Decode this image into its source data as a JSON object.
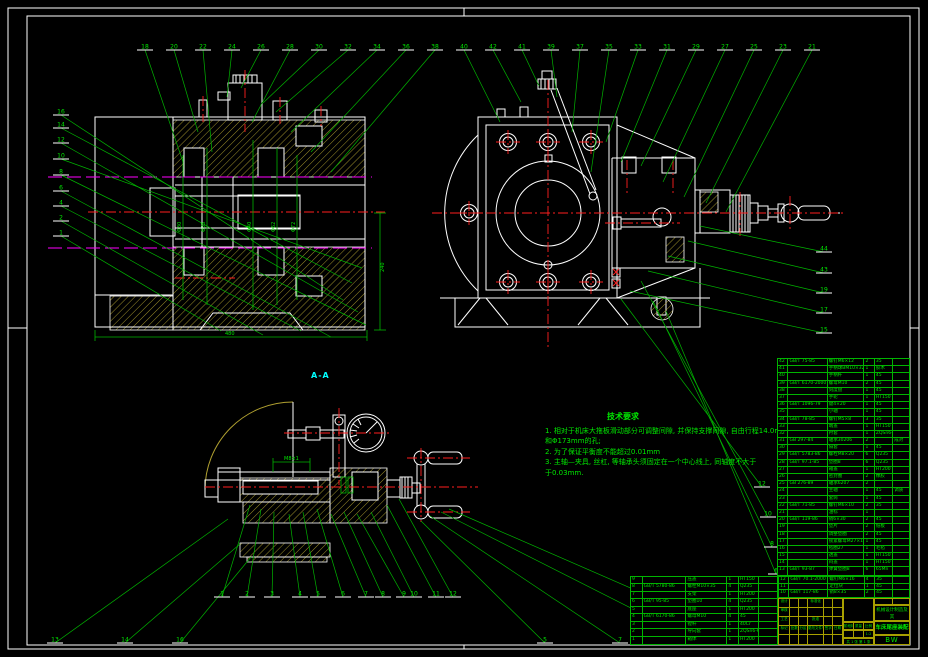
{
  "labels": {
    "section": "A-A"
  },
  "notes": {
    "title": "技术要求",
    "lines": [
      "1. 相对于机床大拖板滑动部分可调整间隙, 并保持支撑间隙, 自由行程14.0mm",
      "和Φ173mm的孔;",
      "2. 为了保证平衡度不能超过0.01mm",
      "3. 主轴—夹具, 丝杠, 等轴承头须固定在一个中心线上,  同轴度不大于",
      "于0.03mm."
    ]
  },
  "dims": {
    "texts": [
      {
        "x": 225,
        "y": 335,
        "s": "480"
      },
      {
        "x": 384,
        "y": 272,
        "rot": -90,
        "s": "240"
      },
      {
        "x": 181,
        "y": 232,
        "rot": -90,
        "s": "Φ30"
      },
      {
        "x": 205,
        "y": 232,
        "rot": -90,
        "s": "Φ35"
      },
      {
        "x": 251,
        "y": 232,
        "rot": -90,
        "s": "Φ40"
      },
      {
        "x": 275,
        "y": 232,
        "rot": -90,
        "s": "Φ62"
      },
      {
        "x": 295,
        "y": 232,
        "rot": -90,
        "s": "Φ72"
      },
      {
        "x": 284,
        "y": 460,
        "s": "M8×1"
      }
    ]
  },
  "callouts": {
    "groups": [
      {
        "name": "top",
        "items": [
          {
            "x": 145,
            "y": 50,
            "tx": 183,
            "ty": 162,
            "n": "18"
          },
          {
            "x": 174,
            "y": 50,
            "tx": 198,
            "ty": 132,
            "n": "20"
          },
          {
            "x": 203,
            "y": 50,
            "tx": 212,
            "ty": 152,
            "n": "22"
          },
          {
            "x": 232,
            "y": 50,
            "tx": 227,
            "ty": 97,
            "n": "24"
          },
          {
            "x": 261,
            "y": 50,
            "tx": 241,
            "ty": 88,
            "n": "26"
          },
          {
            "x": 290,
            "y": 50,
            "tx": 252,
            "ty": 122,
            "n": "28"
          },
          {
            "x": 319,
            "y": 50,
            "tx": 263,
            "ty": 103,
            "n": "30"
          },
          {
            "x": 348,
            "y": 50,
            "tx": 276,
            "ty": 112,
            "n": "32"
          },
          {
            "x": 377,
            "y": 50,
            "tx": 291,
            "ty": 132,
            "n": "34"
          },
          {
            "x": 406,
            "y": 50,
            "tx": 311,
            "ty": 152,
            "n": "36"
          },
          {
            "x": 435,
            "y": 50,
            "tx": 331,
            "ty": 172,
            "n": "38"
          },
          {
            "x": 464,
            "y": 50,
            "tx": 500,
            "ty": 122,
            "n": "40"
          },
          {
            "x": 493,
            "y": 50,
            "tx": 521,
            "ty": 102,
            "n": "42"
          },
          {
            "x": 522,
            "y": 50,
            "tx": 539,
            "ty": 86,
            "n": "41"
          },
          {
            "x": 551,
            "y": 50,
            "tx": 557,
            "ty": 97,
            "n": "39"
          },
          {
            "x": 580,
            "y": 50,
            "tx": 572,
            "ty": 132,
            "n": "37"
          },
          {
            "x": 609,
            "y": 50,
            "tx": 591,
            "ty": 172,
            "n": "35"
          },
          {
            "x": 638,
            "y": 50,
            "tx": 606,
            "ty": 142,
            "n": "33"
          },
          {
            "x": 667,
            "y": 50,
            "tx": 621,
            "ty": 162,
            "n": "31"
          },
          {
            "x": 696,
            "y": 50,
            "tx": 641,
            "ty": 166,
            "n": "29"
          },
          {
            "x": 725,
            "y": 50,
            "tx": 663,
            "ty": 182,
            "n": "27"
          },
          {
            "x": 754,
            "y": 50,
            "tx": 684,
            "ty": 197,
            "n": "25"
          },
          {
            "x": 783,
            "y": 50,
            "tx": 706,
            "ty": 203,
            "n": "23"
          },
          {
            "x": 812,
            "y": 50,
            "tx": 726,
            "ty": 212,
            "n": "21"
          }
        ]
      },
      {
        "name": "left",
        "items": [
          {
            "x": 61,
            "y": 115,
            "tx": 343,
            "ty": 300,
            "n": "16"
          },
          {
            "x": 61,
            "y": 128,
            "tx": 352,
            "ty": 283,
            "n": "14"
          },
          {
            "x": 61,
            "y": 143,
            "tx": 358,
            "ty": 312,
            "n": "12"
          },
          {
            "x": 61,
            "y": 159,
            "tx": 362,
            "ty": 268,
            "n": "10"
          },
          {
            "x": 61,
            "y": 175,
            "tx": 366,
            "ty": 325,
            "n": "8"
          },
          {
            "x": 61,
            "y": 191,
            "tx": 331,
            "ty": 337,
            "n": "6"
          },
          {
            "x": 61,
            "y": 206,
            "tx": 301,
            "ty": 331,
            "n": "4"
          },
          {
            "x": 61,
            "y": 221,
            "tx": 263,
            "ty": 335,
            "n": "2"
          },
          {
            "x": 61,
            "y": 236,
            "tx": 221,
            "ty": 331,
            "n": "1"
          }
        ]
      },
      {
        "name": "right",
        "items": [
          {
            "x": 824,
            "y": 252,
            "tx": 700,
            "ty": 226,
            "n": "44"
          },
          {
            "x": 824,
            "y": 273,
            "tx": 688,
            "ty": 241,
            "n": "43"
          },
          {
            "x": 824,
            "y": 293,
            "tx": 668,
            "ty": 256,
            "n": "19"
          },
          {
            "x": 824,
            "y": 313,
            "tx": 648,
            "ty": 271,
            "n": "17"
          },
          {
            "x": 824,
            "y": 333,
            "tx": 630,
            "ty": 291,
            "n": "15"
          }
        ]
      },
      {
        "name": "bottom-inner",
        "items": [
          {
            "x": 222,
            "y": 597,
            "tx": 250,
            "ty": 505,
            "n": "1"
          },
          {
            "x": 247,
            "y": 597,
            "tx": 261,
            "ty": 509,
            "n": "2"
          },
          {
            "x": 272,
            "y": 597,
            "tx": 274,
            "ty": 512,
            "n": "3"
          },
          {
            "x": 300,
            "y": 597,
            "tx": 289,
            "ty": 514,
            "n": "4"
          },
          {
            "x": 318,
            "y": 597,
            "tx": 303,
            "ty": 512,
            "n": "5"
          },
          {
            "x": 343,
            "y": 597,
            "tx": 317,
            "ty": 509,
            "n": "6"
          },
          {
            "x": 366,
            "y": 597,
            "tx": 331,
            "ty": 514,
            "n": "7"
          },
          {
            "x": 383,
            "y": 597,
            "tx": 344,
            "ty": 512,
            "n": "8"
          },
          {
            "x": 404,
            "y": 597,
            "tx": 357,
            "ty": 514,
            "n": "9"
          },
          {
            "x": 414,
            "y": 597,
            "tx": 371,
            "ty": 512,
            "n": "10"
          },
          {
            "x": 436,
            "y": 597,
            "tx": 387,
            "ty": 505,
            "n": "11"
          },
          {
            "x": 453,
            "y": 597,
            "tx": 399,
            "ty": 499,
            "n": "12"
          }
        ]
      },
      {
        "name": "bottom-outer",
        "items": [
          {
            "x": 55,
            "y": 643,
            "tx": 228,
            "ty": 519,
            "n": "13"
          },
          {
            "x": 125,
            "y": 643,
            "tx": 240,
            "ty": 544,
            "n": "14"
          },
          {
            "x": 180,
            "y": 643,
            "tx": 251,
            "ty": 557,
            "n": "16"
          },
          {
            "x": 545,
            "y": 643,
            "tx": 421,
            "ty": 521,
            "n": "5"
          },
          {
            "x": 620,
            "y": 643,
            "tx": 430,
            "ty": 516,
            "n": "7"
          },
          {
            "x": 700,
            "y": 643,
            "tx": 441,
            "ty": 512,
            "n": "9"
          },
          {
            "x": 757,
            "y": 643,
            "tx": 449,
            "ty": 509,
            "n": "11"
          }
        ]
      },
      {
        "name": "side-lower",
        "items": [
          {
            "x": 762,
            "y": 487,
            "tx": 621,
            "ty": 299,
            "n": "12"
          },
          {
            "x": 768,
            "y": 517,
            "tx": 641,
            "ty": 281,
            "n": "10"
          },
          {
            "x": 772,
            "y": 547,
            "tx": 653,
            "ty": 301,
            "n": "8"
          },
          {
            "x": 776,
            "y": 574,
            "tx": 666,
            "ty": 311,
            "n": "6"
          }
        ]
      }
    ]
  },
  "bom": {
    "columns": [
      "序号",
      "代号",
      "名称",
      "数量",
      "材料",
      "备注"
    ],
    "right_rows": [
      [
        "42",
        "GB/T 75-85",
        "螺钉M6×12",
        "2",
        "35",
        ""
      ],
      [
        "41",
        "",
        "手柄球BM10×32",
        "1",
        "胶木",
        ""
      ],
      [
        "40",
        "",
        "手柄杆",
        "1",
        "45",
        ""
      ],
      [
        "39",
        "GB/T 6170-2000",
        "螺母M10",
        "2",
        "45",
        ""
      ],
      [
        "38",
        "",
        "刻度盘",
        "1",
        "45",
        ""
      ],
      [
        "37",
        "",
        "手轮",
        "1",
        "HT150",
        ""
      ],
      [
        "36",
        "GB/T 1096-79",
        "键4×20",
        "1",
        "45",
        ""
      ],
      [
        "35",
        "",
        "小轴",
        "1",
        "45",
        ""
      ],
      [
        "34",
        "GB/T 78-85",
        "螺钉M5×8",
        "3",
        "35",
        ""
      ],
      [
        "33",
        "",
        "端盖",
        "1",
        "HT150",
        ""
      ],
      [
        "32",
        "",
        "衬套",
        "1",
        "ZQSn6-6-3",
        ""
      ],
      [
        "31",
        "GB 297-84",
        "轴承30206",
        "2",
        "",
        "成对"
      ],
      [
        "30",
        "",
        "隔套",
        "1",
        "45",
        ""
      ],
      [
        "29",
        "GB/T 5783-86",
        "螺栓M8×20",
        "6",
        "Q235",
        ""
      ],
      [
        "28",
        "GB/T 97.1-85",
        "垫圈8",
        "6",
        "Q235",
        ""
      ],
      [
        "27",
        "",
        "箱盖",
        "1",
        "HT200",
        ""
      ],
      [
        "26",
        "",
        "密封圈",
        "2",
        "橡胶",
        ""
      ],
      [
        "25",
        "GB 276-89",
        "轴承6207",
        "2",
        "",
        ""
      ],
      [
        "24",
        "",
        "主轴",
        "1",
        "45",
        "调质"
      ],
      [
        "23",
        "",
        "套筒",
        "1",
        "45",
        ""
      ],
      [
        "22",
        "GB/T 71-85",
        "螺钉M6×10",
        "2",
        "35",
        ""
      ],
      [
        "21",
        "",
        "油标",
        "1",
        "",
        ""
      ],
      [
        "20",
        "GB/T 119-86",
        "销6×30",
        "2",
        "45",
        ""
      ],
      [
        "19",
        "",
        "垫片",
        "2",
        "纸板",
        ""
      ],
      [
        "18",
        "",
        "调整垫圈",
        "2",
        "45",
        ""
      ],
      [
        "17",
        "",
        "锁紧螺母M27×1.5",
        "1",
        "45",
        ""
      ],
      [
        "16",
        "",
        "毡圈27",
        "1",
        "毛毡",
        ""
      ],
      [
        "15",
        "",
        "透盖",
        "1",
        "HT150",
        ""
      ],
      [
        "14",
        "",
        "闷盖",
        "1",
        "HT150",
        ""
      ],
      [
        "13",
        "GB/T 93-87",
        "弹簧垫圈8",
        "6",
        "65Mn",
        ""
      ]
    ],
    "corner_rows": [
      [
        "12",
        "GB/T 70.1-2000",
        "螺钉M6×16",
        "4",
        "35",
        ""
      ],
      [
        "11",
        "",
        "定位块",
        "1",
        "45",
        ""
      ],
      [
        "10",
        "GB/T 117-86",
        "销8×35",
        "2",
        "45",
        ""
      ]
    ],
    "left_rows": [
      [
        "9",
        "",
        "压盖",
        "1",
        "HT150",
        ""
      ],
      [
        "8",
        "GB/T 5780-86",
        "螺栓M10×35",
        "4",
        "Q235",
        ""
      ],
      [
        "7",
        "",
        "支架",
        "1",
        "HT200",
        ""
      ],
      [
        "6",
        "GB/T 95-85",
        "垫圈10",
        "4",
        "Q235",
        ""
      ],
      [
        "5",
        "",
        "底座",
        "1",
        "HT200",
        ""
      ],
      [
        "4",
        "GB/T 6170-86",
        "螺母M10",
        "4",
        "45",
        ""
      ],
      [
        "3",
        "",
        "镗杆",
        "1",
        "40Cr",
        ""
      ],
      [
        "2",
        "",
        "导向套",
        "1",
        "ZQSn6-6-3",
        ""
      ],
      [
        "1",
        "",
        "箱体",
        "1",
        "HT200",
        ""
      ]
    ]
  },
  "titleblock": {
    "grid": [
      [
        "设计",
        "",
        "",
        "标准化",
        "",
        ""
      ],
      [
        "审核",
        "",
        "",
        "",
        "",
        ""
      ],
      [
        "工艺",
        "",
        "",
        "批准",
        "",
        ""
      ],
      [
        "标记",
        "处数",
        "分区",
        "更改文件号",
        "签字",
        "日期"
      ],
      [
        "",
        "",
        "",
        "",
        "",
        ""
      ]
    ],
    "stage": "阶段标记",
    "mass_label": "质量",
    "scale_label": "比例",
    "scale": "1:2",
    "sheets": "共 1 张  第 1 张",
    "school_line1": "机械设计制造及其",
    "school_line2": "自动化 0403-12",
    "title": "车床尾座装配图",
    "code": "BW"
  }
}
